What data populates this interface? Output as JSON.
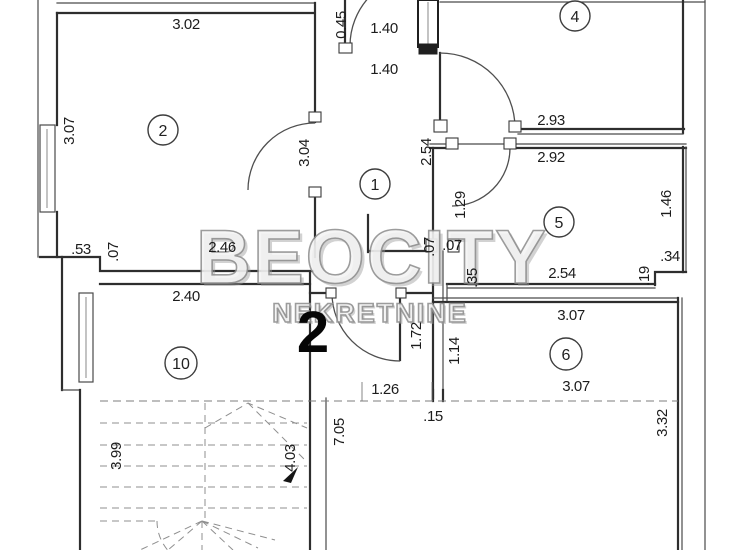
{
  "plan": {
    "watermark": {
      "line1": "BEOCITY",
      "line2": "NEKRETNINE"
    },
    "floor_number": "2"
  },
  "rooms": [
    {
      "label": "2"
    },
    {
      "label": "4"
    },
    {
      "label": "1"
    },
    {
      "label": "5"
    },
    {
      "label": "6"
    },
    {
      "label": "10"
    }
  ],
  "dims": [
    "3.02",
    "0.45",
    "1.40",
    "1.40",
    "3.07",
    "3.04",
    "2.54",
    "2.93",
    "2.92",
    "1.29",
    "1.46",
    ".53",
    ".07",
    "2.46",
    ".07",
    ".07",
    ".35",
    "2.54",
    ".19",
    ".34",
    "2.40",
    "1.72",
    "1.14",
    "3.07",
    "3.07",
    "1.26",
    ".15",
    "3.32",
    "3.99",
    "4.03",
    "7.05"
  ],
  "colors": {
    "line": "#2e2e2e",
    "dim_text": "#1c1c1c",
    "watermark": "#949494",
    "stairs_dash": "#8f8f8f",
    "background": "#ffffff"
  }
}
